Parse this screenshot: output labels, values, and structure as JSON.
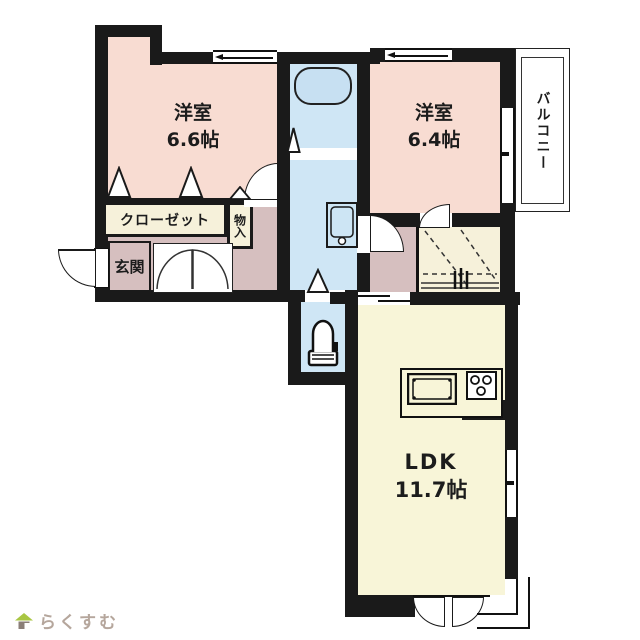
{
  "plan": {
    "bedroom1": {
      "label": "洋室",
      "area": "6.6帖"
    },
    "bedroom2": {
      "label": "洋室",
      "area": "6.4帖"
    },
    "ldk": {
      "label": "LDK",
      "area": "11.7帖"
    },
    "balcony_label": "バルコニー",
    "closet_label": "クローゼット",
    "storage_label": "物入",
    "entrance_label": "玄関",
    "fixtures": [
      "bathtub-icon",
      "washbasin-icon",
      "toilet-icon",
      "kitchen-sink-icon",
      "stove-icon"
    ],
    "colors": {
      "wall": "#1a1a1a",
      "bedroom_floor": "#f8dcd2",
      "hall_floor": "#d6bfbf",
      "wet_area_floor": "#cfe6f5",
      "ldk_floor": "#f8f5d8",
      "closet_floor": "#f6f1da"
    }
  },
  "footer": {
    "logo_text": "らくすむ",
    "logo_colors": {
      "roof": "#a9c643",
      "body": "#8b7f78",
      "text": "#b5a69c"
    }
  }
}
